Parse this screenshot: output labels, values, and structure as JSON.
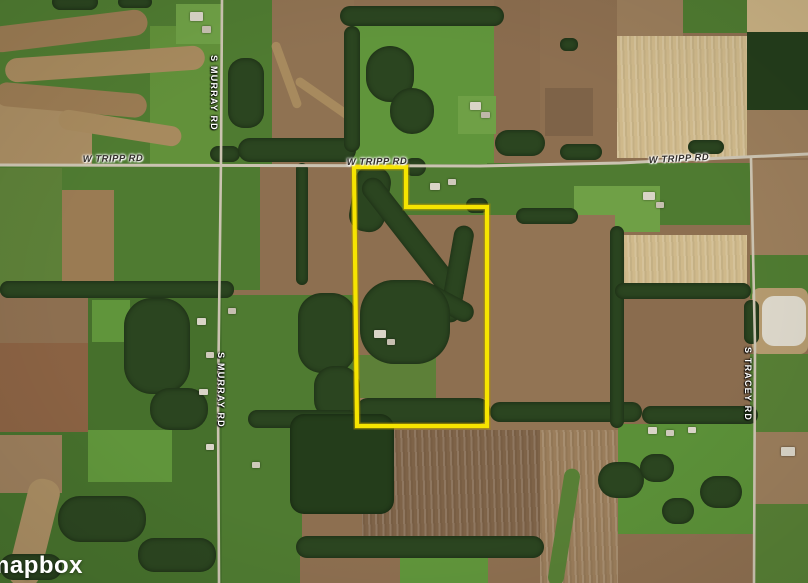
{
  "map": {
    "attribution": "mapbox",
    "boundary": {
      "color": "#f6e400",
      "halo_color": "#a98c00",
      "points": "354,167 406,167 406,207 487,207 487,426 357,426"
    },
    "roads": [
      {
        "name": "w-tripp-rd",
        "d": "M0,165 L480,166 L620,163 L808,154"
      },
      {
        "name": "s-murray-rd",
        "d": "M222,0 L221,160 L218,400 L219,583"
      },
      {
        "name": "s-tracey-rd",
        "d": "M751,158 L755,345 L754,583"
      }
    ],
    "road_labels": [
      {
        "text": "W TRIPP RD",
        "x": 113,
        "y": 159,
        "rot": -1,
        "style": "dark"
      },
      {
        "text": "W TRIPP RD",
        "x": 377,
        "y": 162,
        "rot": -1,
        "style": "dark"
      },
      {
        "text": "W TRIPP RD",
        "x": 679,
        "y": 159,
        "rot": -3,
        "style": "dark"
      },
      {
        "text": "S MURRAY RD",
        "x": 214,
        "y": 93,
        "rot": 90,
        "style": "light"
      },
      {
        "text": "S MURRAY RD",
        "x": 221,
        "y": 390,
        "rot": 90,
        "style": "light"
      },
      {
        "text": "S TRACEY RD",
        "x": 748,
        "y": 384,
        "rot": 90,
        "style": "light"
      }
    ],
    "patches": [
      {
        "x": 0,
        "y": 0,
        "w": 222,
        "h": 165,
        "c": "#4f7b31"
      },
      {
        "x": 150,
        "y": 26,
        "w": 72,
        "h": 138,
        "c": "#62913a"
      },
      {
        "x": 0,
        "y": 100,
        "w": 92,
        "h": 65,
        "c": "#a88c62"
      },
      {
        "x": -12,
        "y": 18,
        "w": 160,
        "h": 26,
        "c": "#9a7b53",
        "r": 14,
        "rot": -7
      },
      {
        "x": 5,
        "y": 52,
        "w": 200,
        "h": 24,
        "c": "#a78a5e",
        "r": 12,
        "rot": -4
      },
      {
        "x": -5,
        "y": 88,
        "w": 152,
        "h": 24,
        "c": "#9a7b53",
        "r": 12,
        "rot": 5
      },
      {
        "x": 58,
        "y": 118,
        "w": 124,
        "h": 20,
        "c": "#a78a5e",
        "r": 10,
        "rot": 9
      },
      {
        "x": 176,
        "y": 4,
        "w": 46,
        "h": 40,
        "c": "#6fa046"
      },
      {
        "x": 222,
        "y": 0,
        "w": 50,
        "h": 165,
        "c": "#4f7b31"
      },
      {
        "x": 272,
        "y": 0,
        "w": 82,
        "h": 165,
        "c": "#8f7252"
      },
      {
        "x": 282,
        "y": 40,
        "w": 9,
        "h": 70,
        "c": "#a78a5e",
        "r": 5,
        "rot": -20
      },
      {
        "x": 290,
        "y": 95,
        "w": 70,
        "h": 9,
        "c": "#a78a5e",
        "r": 5,
        "rot": 35
      },
      {
        "x": 352,
        "y": 163,
        "w": 140,
        "h": 52,
        "c": "#4f7b31"
      },
      {
        "x": 352,
        "y": 24,
        "w": 142,
        "h": 140,
        "c": "#60953b"
      },
      {
        "x": 494,
        "y": 0,
        "w": 46,
        "h": 134,
        "c": "#8a6c4e"
      },
      {
        "x": 458,
        "y": 96,
        "w": 38,
        "h": 38,
        "c": "#6fa046"
      },
      {
        "x": 540,
        "y": 0,
        "w": 78,
        "h": 160,
        "c": "#8d6f50"
      },
      {
        "x": 545,
        "y": 88,
        "w": 48,
        "h": 48,
        "c": "#7e6348"
      },
      {
        "x": 617,
        "y": 0,
        "w": 66,
        "h": 38,
        "c": "#9a7d5b"
      },
      {
        "x": 683,
        "y": 0,
        "w": 64,
        "h": 33,
        "c": "#4f7b31"
      },
      {
        "x": 747,
        "y": 0,
        "w": 61,
        "h": 32,
        "c": "#c9b183"
      },
      {
        "x": 617,
        "y": 36,
        "w": 130,
        "h": 122,
        "c": "#cfb98b",
        "s": 1
      },
      {
        "x": 747,
        "y": 32,
        "w": 61,
        "h": 78,
        "c": "#243d1b"
      },
      {
        "x": 747,
        "y": 110,
        "w": 61,
        "h": 48,
        "c": "#9a7d5b"
      },
      {
        "x": 0,
        "y": 165,
        "w": 222,
        "h": 128,
        "c": "#4f7b31"
      },
      {
        "x": 0,
        "y": 168,
        "w": 62,
        "h": 118,
        "c": "#5d8038"
      },
      {
        "x": 62,
        "y": 190,
        "w": 52,
        "h": 96,
        "c": "#9a7b53"
      },
      {
        "x": 0,
        "y": 295,
        "w": 88,
        "h": 48,
        "c": "#8d6f50"
      },
      {
        "x": 0,
        "y": 343,
        "w": 88,
        "h": 92,
        "c": "#8a6243"
      },
      {
        "x": 88,
        "y": 292,
        "w": 134,
        "h": 143,
        "c": "#46702c"
      },
      {
        "x": 92,
        "y": 300,
        "w": 38,
        "h": 42,
        "c": "#60953b"
      },
      {
        "x": 222,
        "y": 165,
        "w": 38,
        "h": 125,
        "c": "#4f7b31"
      },
      {
        "x": 260,
        "y": 165,
        "w": 95,
        "h": 128,
        "c": "#8d6f50"
      },
      {
        "x": 222,
        "y": 295,
        "w": 133,
        "h": 135,
        "c": "#4f7b31"
      },
      {
        "x": 487,
        "y": 163,
        "w": 263,
        "h": 62,
        "c": "#4f7b31"
      },
      {
        "x": 574,
        "y": 186,
        "w": 86,
        "h": 46,
        "c": "#6fa046"
      },
      {
        "x": 487,
        "y": 215,
        "w": 128,
        "h": 215,
        "c": "#927454"
      },
      {
        "x": 615,
        "y": 235,
        "w": 132,
        "h": 58,
        "c": "#cfb98b",
        "s": 1
      },
      {
        "x": 615,
        "y": 293,
        "w": 132,
        "h": 132,
        "c": "#8a6c4e"
      },
      {
        "x": 750,
        "y": 160,
        "w": 58,
        "h": 95,
        "c": "#9a7d5b"
      },
      {
        "x": 750,
        "y": 255,
        "w": 58,
        "h": 44,
        "c": "#4f7b31"
      },
      {
        "x": 752,
        "y": 288,
        "w": 56,
        "h": 66,
        "c": "#b49a6f",
        "r": 8
      },
      {
        "x": 762,
        "y": 296,
        "w": 44,
        "h": 50,
        "c": "#dcd7ca",
        "r": 12
      },
      {
        "x": 750,
        "y": 354,
        "w": 58,
        "h": 78,
        "c": "#577f35"
      },
      {
        "x": 750,
        "y": 432,
        "w": 58,
        "h": 72,
        "c": "#9a7d5b"
      },
      {
        "x": 750,
        "y": 504,
        "w": 58,
        "h": 79,
        "c": "#577f35"
      },
      {
        "x": 0,
        "y": 432,
        "w": 222,
        "h": 151,
        "c": "#46702c"
      },
      {
        "x": 0,
        "y": 435,
        "w": 62,
        "h": 58,
        "c": "#9a7d5b"
      },
      {
        "x": 88,
        "y": 430,
        "w": 84,
        "h": 52,
        "c": "#60953b"
      },
      {
        "x": 18,
        "y": 478,
        "w": 32,
        "h": 110,
        "c": "#a88c62",
        "r": 14,
        "rot": 14
      },
      {
        "x": 222,
        "y": 430,
        "w": 80,
        "h": 153,
        "c": "#4f7b31"
      },
      {
        "x": 362,
        "y": 430,
        "w": 178,
        "h": 116,
        "c": "#7e6348",
        "s": 1
      },
      {
        "x": 300,
        "y": 556,
        "w": 240,
        "h": 27,
        "c": "#8d6f50"
      },
      {
        "x": 400,
        "y": 548,
        "w": 88,
        "h": 35,
        "c": "#60953b"
      },
      {
        "x": 540,
        "y": 430,
        "w": 80,
        "h": 153,
        "c": "#9a7d5b",
        "s": 1
      },
      {
        "x": 556,
        "y": 468,
        "w": 16,
        "h": 118,
        "c": "#577f35",
        "r": 8,
        "rot": 9
      },
      {
        "x": 618,
        "y": 424,
        "w": 137,
        "h": 110,
        "c": "#5b9038"
      },
      {
        "x": 618,
        "y": 534,
        "w": 137,
        "h": 49,
        "c": "#8d6f50"
      },
      {
        "x": 356,
        "y": 355,
        "w": 80,
        "h": 46,
        "c": "#5d8038"
      },
      {
        "x": 358,
        "y": 398,
        "w": 130,
        "h": 28,
        "c": "#9a7d5b"
      }
    ],
    "trees": [
      {
        "x": 52,
        "y": -6,
        "w": 46,
        "h": 16,
        "r": 8
      },
      {
        "x": 118,
        "y": -4,
        "w": 34,
        "h": 12,
        "r": 6
      },
      {
        "x": 228,
        "y": 58,
        "w": 36,
        "h": 70,
        "r": 16
      },
      {
        "x": 210,
        "y": 146,
        "w": 30,
        "h": 16,
        "r": 8
      },
      {
        "x": 238,
        "y": 138,
        "w": 118,
        "h": 24,
        "r": 12
      },
      {
        "x": 340,
        "y": 6,
        "w": 164,
        "h": 20,
        "r": 10
      },
      {
        "x": 344,
        "y": 26,
        "w": 16,
        "h": 126,
        "r": 8
      },
      {
        "x": 366,
        "y": 46,
        "w": 48,
        "h": 56,
        "r": 28
      },
      {
        "x": 390,
        "y": 88,
        "w": 44,
        "h": 46,
        "r": 22
      },
      {
        "x": 495,
        "y": 130,
        "w": 50,
        "h": 26,
        "r": 13
      },
      {
        "x": 560,
        "y": 144,
        "w": 42,
        "h": 16,
        "r": 8
      },
      {
        "x": 688,
        "y": 140,
        "w": 36,
        "h": 14,
        "r": 7
      },
      {
        "x": 560,
        "y": 38,
        "w": 18,
        "h": 13,
        "r": 6
      },
      {
        "x": 0,
        "y": 281,
        "w": 234,
        "h": 17,
        "r": 8
      },
      {
        "x": 124,
        "y": 298,
        "w": 66,
        "h": 96,
        "r": 28
      },
      {
        "x": 150,
        "y": 388,
        "w": 58,
        "h": 42,
        "r": 20
      },
      {
        "x": 298,
        "y": 293,
        "w": 58,
        "h": 80,
        "r": 24
      },
      {
        "x": 314,
        "y": 366,
        "w": 46,
        "h": 54,
        "r": 20
      },
      {
        "x": 296,
        "y": 163,
        "w": 12,
        "h": 122,
        "r": 6
      },
      {
        "x": 352,
        "y": 166,
        "w": 36,
        "h": 66,
        "r": 16,
        "rot": 10
      },
      {
        "x": 337,
        "y": 229,
        "w": 152,
        "h": 22,
        "r": 12,
        "rot": 52
      },
      {
        "x": 447,
        "y": 225,
        "w": 20,
        "h": 98,
        "r": 10,
        "rot": 10
      },
      {
        "x": 418,
        "y": 293,
        "w": 58,
        "h": 20,
        "r": 10,
        "rot": 28
      },
      {
        "x": 360,
        "y": 280,
        "w": 90,
        "h": 84,
        "r": 34
      },
      {
        "x": 356,
        "y": 398,
        "w": 134,
        "h": 26,
        "r": 12
      },
      {
        "x": 490,
        "y": 402,
        "w": 152,
        "h": 20,
        "r": 10
      },
      {
        "x": 642,
        "y": 406,
        "w": 116,
        "h": 18,
        "r": 9
      },
      {
        "x": 248,
        "y": 410,
        "w": 110,
        "h": 18,
        "r": 9
      },
      {
        "x": 610,
        "y": 226,
        "w": 14,
        "h": 202,
        "r": 7
      },
      {
        "x": 615,
        "y": 283,
        "w": 136,
        "h": 16,
        "r": 8
      },
      {
        "x": 290,
        "y": 414,
        "w": 104,
        "h": 100,
        "r": 14,
        "c": "#243d1b"
      },
      {
        "x": 296,
        "y": 536,
        "w": 248,
        "h": 22,
        "r": 11
      },
      {
        "x": 58,
        "y": 496,
        "w": 88,
        "h": 46,
        "r": 22
      },
      {
        "x": 138,
        "y": 538,
        "w": 78,
        "h": 34,
        "r": 16
      },
      {
        "x": 0,
        "y": 554,
        "w": 62,
        "h": 26,
        "r": 13
      },
      {
        "x": 598,
        "y": 462,
        "w": 46,
        "h": 36,
        "r": 18
      },
      {
        "x": 640,
        "y": 454,
        "w": 34,
        "h": 28,
        "r": 14
      },
      {
        "x": 700,
        "y": 476,
        "w": 42,
        "h": 32,
        "r": 16
      },
      {
        "x": 662,
        "y": 498,
        "w": 32,
        "h": 26,
        "r": 13
      },
      {
        "x": 404,
        "y": 158,
        "w": 22,
        "h": 18,
        "r": 9
      },
      {
        "x": 466,
        "y": 198,
        "w": 22,
        "h": 15,
        "r": 7
      },
      {
        "x": 516,
        "y": 208,
        "w": 62,
        "h": 16,
        "r": 8
      },
      {
        "x": 744,
        "y": 300,
        "w": 15,
        "h": 44,
        "r": 7
      }
    ],
    "buildings": [
      {
        "x": 190,
        "y": 12,
        "w": 13,
        "h": 9
      },
      {
        "x": 202,
        "y": 26,
        "w": 9,
        "h": 7,
        "c": "#c6bfb0"
      },
      {
        "x": 470,
        "y": 102,
        "w": 11,
        "h": 8
      },
      {
        "x": 481,
        "y": 112,
        "w": 9,
        "h": 6,
        "c": "#beb7a8"
      },
      {
        "x": 643,
        "y": 192,
        "w": 12,
        "h": 8
      },
      {
        "x": 656,
        "y": 202,
        "w": 8,
        "h": 6,
        "c": "#c6bfb0"
      },
      {
        "x": 374,
        "y": 330,
        "w": 12,
        "h": 8
      },
      {
        "x": 387,
        "y": 339,
        "w": 8,
        "h": 6,
        "c": "#c6bfb0"
      },
      {
        "x": 430,
        "y": 183,
        "w": 10,
        "h": 7
      },
      {
        "x": 448,
        "y": 179,
        "w": 8,
        "h": 6,
        "c": "#cfc9bb"
      },
      {
        "x": 197,
        "y": 318,
        "w": 9,
        "h": 7
      },
      {
        "x": 206,
        "y": 352,
        "w": 8,
        "h": 6,
        "c": "#cfc9bb"
      },
      {
        "x": 199,
        "y": 389,
        "w": 9,
        "h": 6
      },
      {
        "x": 228,
        "y": 308,
        "w": 8,
        "h": 6,
        "c": "#c6bfb0"
      },
      {
        "x": 206,
        "y": 444,
        "w": 8,
        "h": 6
      },
      {
        "x": 252,
        "y": 462,
        "w": 8,
        "h": 6,
        "c": "#cfc9bb"
      },
      {
        "x": 648,
        "y": 427,
        "w": 9,
        "h": 7
      },
      {
        "x": 666,
        "y": 430,
        "w": 8,
        "h": 6,
        "c": "#cfc9bb"
      },
      {
        "x": 688,
        "y": 427,
        "w": 8,
        "h": 6
      },
      {
        "x": 781,
        "y": 447,
        "w": 14,
        "h": 9
      }
    ]
  }
}
